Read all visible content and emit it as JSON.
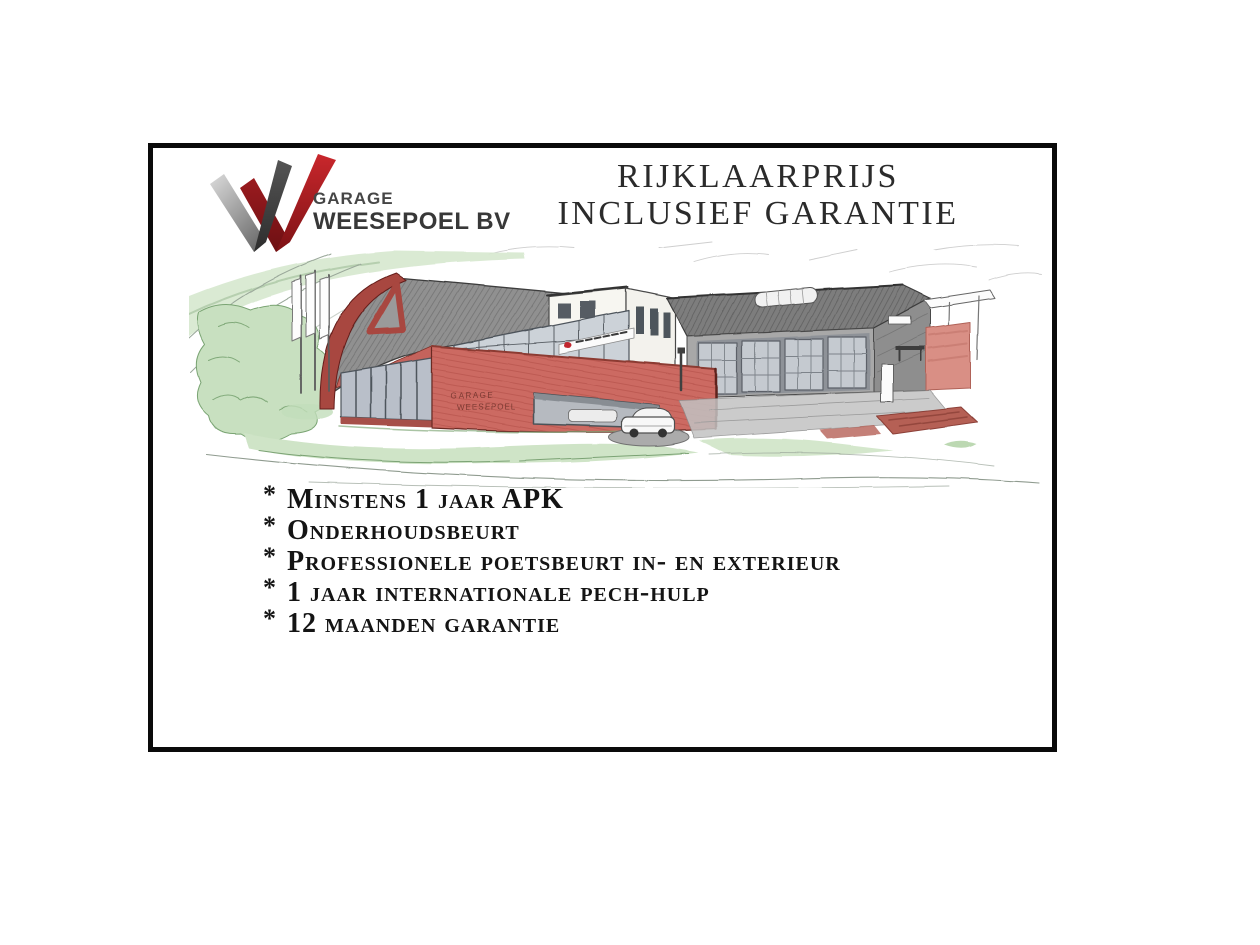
{
  "page": {
    "background": "#ffffff"
  },
  "frame": {
    "border_color": "#0a0a0a"
  },
  "logo": {
    "name_top": "GARAGE",
    "name_bottom": "WEESEPOEL BV",
    "colors": {
      "grey_light": "#d6d6d6",
      "grey_dark": "#3a3a3a",
      "red_bright": "#c9272c",
      "red_dark": "#6d1013",
      "text": "#3f3f3f"
    }
  },
  "header": {
    "title_line1": "RIJKLAARPRIJS",
    "title_line2": "INCLUSIEF GARANTIE",
    "color": "#2b2b2b"
  },
  "illustration": {
    "wall_sign_line1": "GARAGE",
    "wall_sign_line2": "WEESEPOEL",
    "colors": {
      "building_red": "#cc6a62",
      "roof_grey": "#8f8f8f",
      "glass_grey": "#ccd2d8",
      "grass_green": "#cfe4c7",
      "paving_red": "#b56055"
    }
  },
  "benefits": {
    "bullet": "*",
    "items": [
      "Minstens 1 jaar APK",
      "Onderhoudsbeurt",
      "Professionele poetsbeurt in- en exterieur",
      "1 jaar internationale pech-hulp",
      "12 maanden garantie"
    ]
  }
}
